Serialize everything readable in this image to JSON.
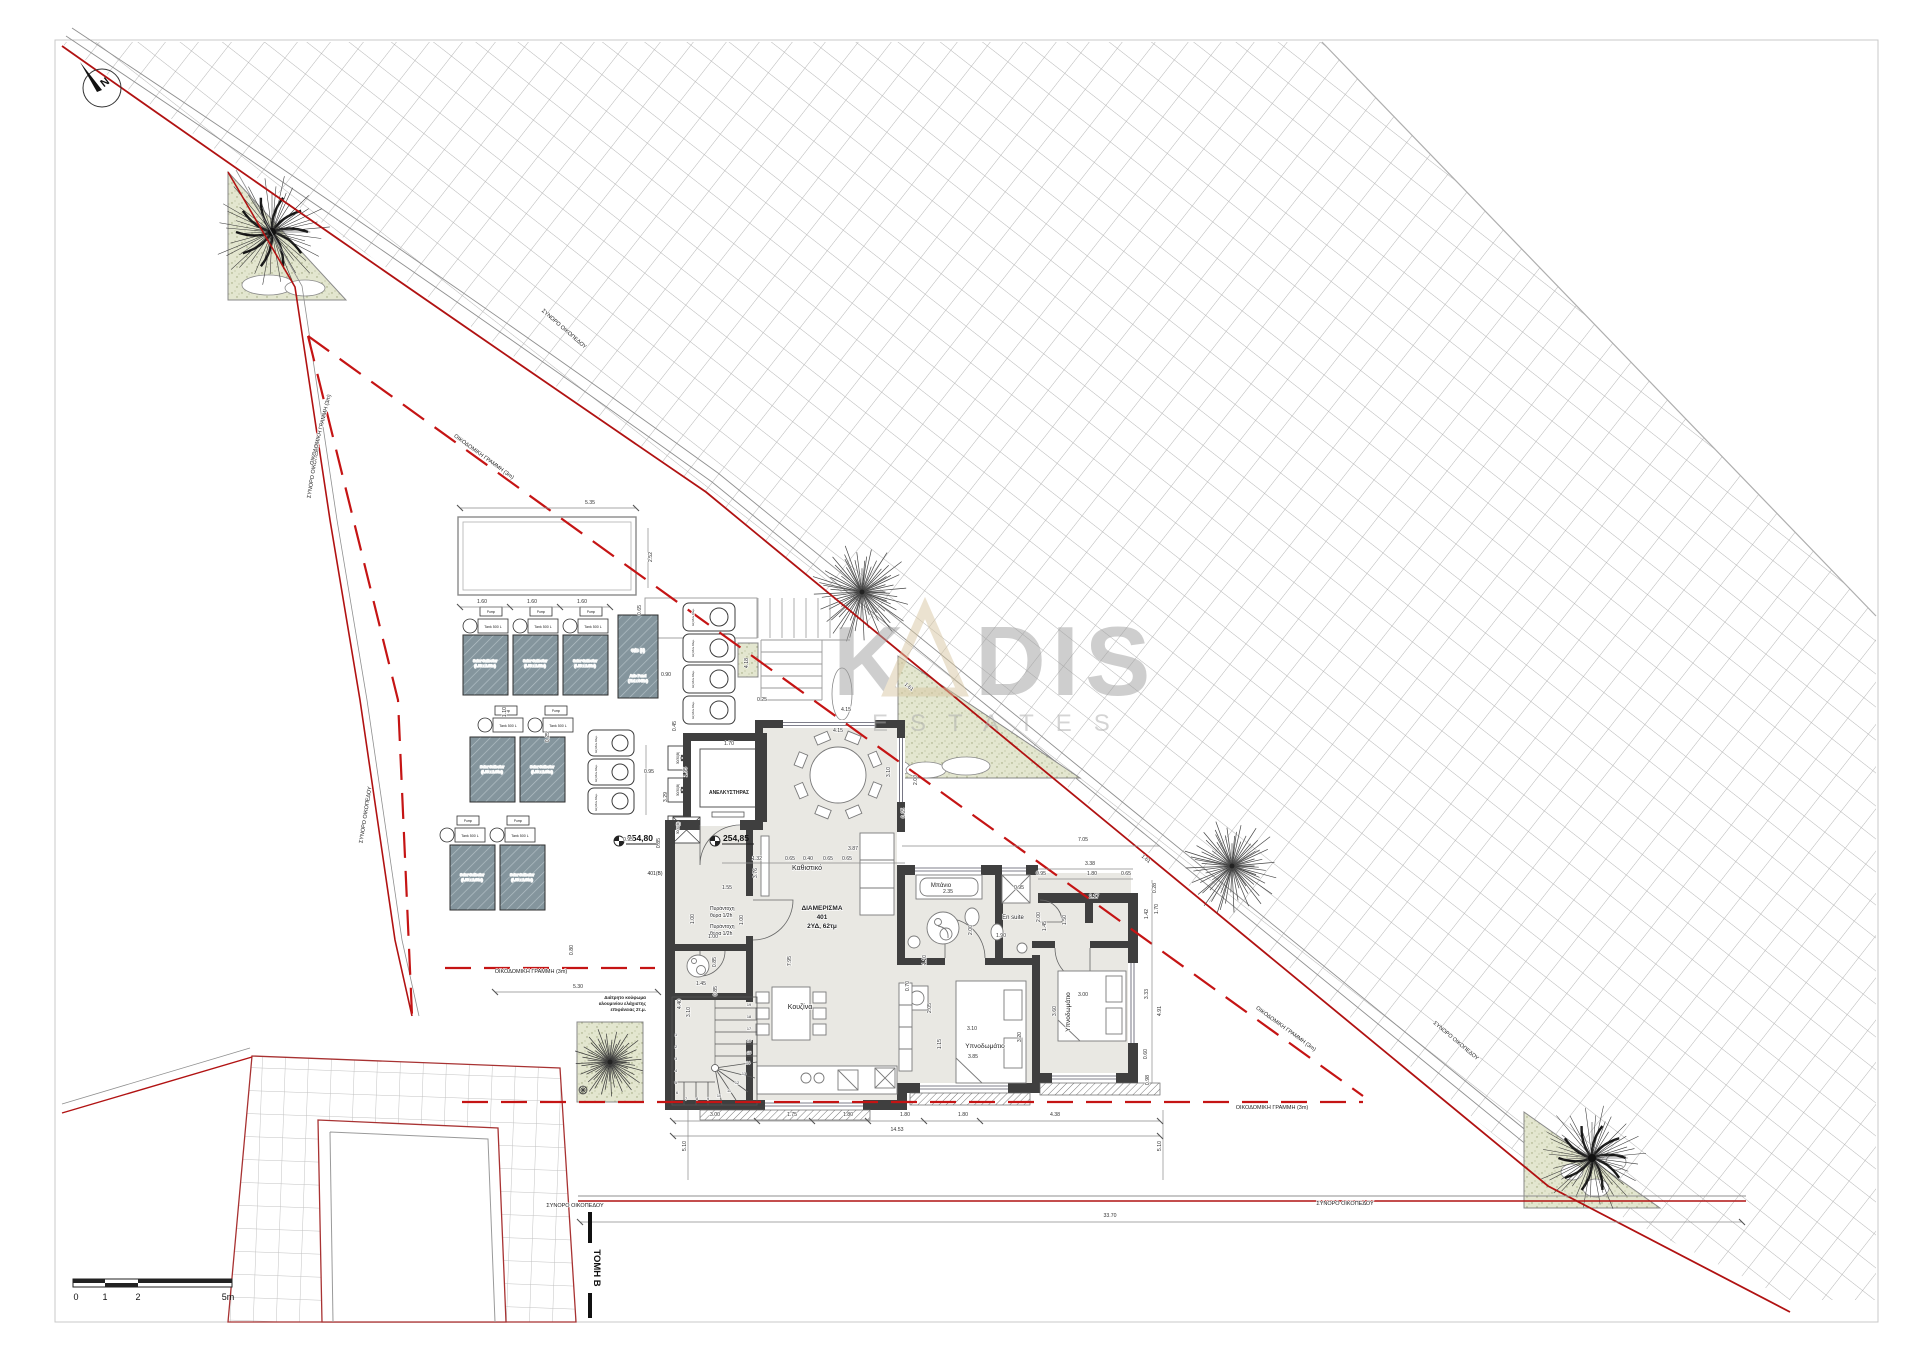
{
  "north_label": "N",
  "watermark": {
    "k": "K",
    "dis": "DIS",
    "estates": "ESTATES"
  },
  "section_mark": "ΤΟΜΗ Β",
  "scalebar": {
    "labels": [
      "0",
      "1",
      "2",
      "5m"
    ]
  },
  "elevations": [
    "254,80",
    "254,85"
  ],
  "apartment": {
    "name": "ΔΙΑΜΕΡΙΣΜΑ",
    "number": "401",
    "info": "2ΥΔ, 62τμ"
  },
  "boundary_label": "ΣΥΝΟΡΟ ΟΙΚΟΠΕΔΟΥ",
  "setback_label": "ΟΙΚΟΔΟΜΙΚΗ ΓΡΑΜΜΗ (3m)",
  "equipment": {
    "elevator": "ΑΝΕΛΚΥΣΤΗΡΑΣ",
    "pump": "Pump",
    "tank": "Tank 500 L",
    "solar1": "Solar Collector",
    "solar2": "(1.00 x 2.00m)",
    "pv1": "Φ/Β (3)",
    "pv2": "Auto Panel",
    "pv3": "(714 x 347m)",
    "ac": "Εξ.Μον.Κλιμ.",
    "shaft": "30/30(Β)"
  },
  "texts": [
    {
      "n": "boundary-label",
      "t": "ΣΥΝΟΡΟ ΟΙΚΟΠΕΔΟΥ",
      "x": 315,
      "y": 470,
      "r": -81,
      "s": 5.5
    },
    {
      "n": "boundary-label",
      "t": "ΣΥΝΟΡΟ ΟΙΚΟΠΕΔΟΥ",
      "x": 367,
      "y": 815,
      "r": -81,
      "s": 5.5
    },
    {
      "n": "boundary-label",
      "t": "ΣΥΝΟΡΟ ΟΙΚΟΠΕΔΟΥ",
      "x": 563,
      "y": 330,
      "r": 41,
      "s": 5.5
    },
    {
      "n": "boundary-label",
      "t": "ΣΥΝΟΡΟ ΟΙΚΟΠΕΔΟΥ",
      "x": 1455,
      "y": 1042,
      "r": 40,
      "s": 5.5
    },
    {
      "n": "boundary-label",
      "t": "ΣΥΝΟΡΟ ΟΙΚΟΠΕΔΟΥ",
      "x": 575,
      "y": 1207,
      "s": 5.5
    },
    {
      "n": "boundary-label",
      "t": "ΣΥΝΟΡΟ ΟΙΚΟΠΕΔΟΥ",
      "x": 1345,
      "y": 1205,
      "s": 5.5
    },
    {
      "n": "setback-label",
      "t": "ΟΙΚΟΔΟΜΙΚΗ ΓΡΑΜΜΗ (3m)",
      "x": 322,
      "y": 430,
      "r": -76,
      "s": 5.5
    },
    {
      "n": "setback-label",
      "t": "ΟΙΚΟΔΟΜΙΚΗ ΓΡΑΜΜΗ (3m)",
      "x": 483,
      "y": 458,
      "r": 36,
      "s": 5.5
    },
    {
      "n": "setback-label",
      "t": "ΟΙΚΟΔΟΜΙΚΗ ΓΡΑΜΜΗ (3m)",
      "x": 531,
      "y": 973,
      "s": 5.5
    },
    {
      "n": "setback-label",
      "t": "ΟΙΚΟΔΟΜΙΚΗ ΓΡΑΜΜΗ (3m)",
      "x": 1285,
      "y": 1030,
      "r": 36,
      "s": 5.5
    },
    {
      "n": "setback-label",
      "t": "ΟΙΚΟΔΟΜΙΚΗ ΓΡΑΜΜΗ (3m)",
      "x": 1272,
      "y": 1109,
      "s": 5.5
    },
    {
      "n": "room-label",
      "t": "Καθιστικό",
      "x": 807,
      "y": 870,
      "s": 7
    },
    {
      "n": "room-label",
      "t": "Κουζίνα",
      "x": 800,
      "y": 1009,
      "s": 7
    },
    {
      "n": "room-label",
      "t": "Μπάνιο",
      "x": 941,
      "y": 887,
      "s": 6
    },
    {
      "n": "room-label",
      "t": "En suite",
      "x": 1013,
      "y": 919,
      "s": 6
    },
    {
      "n": "room-label",
      "t": "Υπνοδωμάτιο",
      "x": 985,
      "y": 1048,
      "s": 6.5
    },
    {
      "n": "room-label",
      "t": "Υπνοδωμάτιο",
      "x": 1070,
      "y": 1012,
      "r": -90,
      "s": 6.5
    },
    {
      "n": "elevator-label",
      "t": "ΑΝΕΛΚΥΣΤΗΡΑΣ",
      "x": 729,
      "y": 794,
      "s": 5,
      "w": 700
    },
    {
      "n": "apartment-title",
      "t": "ΔΙΑΜΕΡΙΣΜΑ",
      "x": 822,
      "y": 910,
      "s": 6.5,
      "w": 700
    },
    {
      "n": "apartment-title",
      "t": "401",
      "x": 822,
      "y": 919,
      "s": 6.5,
      "w": 700
    },
    {
      "n": "apartment-title",
      "t": "2ΥΔ, 62τμ",
      "x": 822,
      "y": 928,
      "s": 6.5,
      "w": 700
    },
    {
      "n": "fire-door-label",
      "t": "Πυράντοχη",
      "x": 710,
      "y": 910,
      "s": 5,
      "a": "start"
    },
    {
      "n": "fire-door-label",
      "t": "θύρα 1/2h",
      "x": 710,
      "y": 917,
      "s": 5,
      "a": "start"
    },
    {
      "n": "fire-door-label",
      "t": "Πυράντοχη",
      "x": 710,
      "y": 928,
      "s": 5,
      "a": "start"
    },
    {
      "n": "fire-door-label",
      "t": "θύρα 1/2h",
      "x": 710,
      "y": 935,
      "s": 5,
      "a": "start"
    },
    {
      "n": "door-tag",
      "t": "401(Β)",
      "x": 655,
      "y": 875,
      "s": 5
    },
    {
      "n": "note",
      "t": "Διάτρητο κούφωμα",
      "x": 646,
      "y": 999,
      "s": 4.6,
      "a": "end",
      "w": 700
    },
    {
      "n": "note",
      "t": "αλουμινίου ελάχιστης",
      "x": 646,
      "y": 1005,
      "s": 4.6,
      "a": "end",
      "w": 700
    },
    {
      "n": "note",
      "t": "επιφάνειας 2τ.μ.",
      "x": 646,
      "y": 1011,
      "s": 4.6,
      "a": "end",
      "w": 700
    },
    {
      "n": "equipment-label",
      "t": "Solar Collector",
      "x": 485,
      "y": 662,
      "s": 3.4,
      "c": "#f2f5f5",
      "w": 600
    },
    {
      "n": "equipment-label",
      "t": "(1.00 x 2.00m)",
      "x": 485,
      "y": 667,
      "s": 3.4,
      "c": "#f2f5f5"
    },
    {
      "n": "equipment-label",
      "t": "Solar Collector",
      "x": 535,
      "y": 662,
      "s": 3.4,
      "c": "#f2f5f5",
      "w": 600
    },
    {
      "n": "equipment-label",
      "t": "(1.00 x 2.00m)",
      "x": 535,
      "y": 667,
      "s": 3.4,
      "c": "#f2f5f5"
    },
    {
      "n": "equipment-label",
      "t": "Solar Collector",
      "x": 585,
      "y": 662,
      "s": 3.4,
      "c": "#f2f5f5",
      "w": 600
    },
    {
      "n": "equipment-label",
      "t": "(1.00 x 2.00m)",
      "x": 585,
      "y": 667,
      "s": 3.4,
      "c": "#f2f5f5"
    },
    {
      "n": "equipment-label",
      "t": "Solar Collector",
      "x": 492,
      "y": 768,
      "s": 3.4,
      "c": "#f2f5f5",
      "w": 600
    },
    {
      "n": "equipment-label",
      "t": "(1.00 x 2.00m)",
      "x": 492,
      "y": 773,
      "s": 3.4,
      "c": "#f2f5f5"
    },
    {
      "n": "equipment-label",
      "t": "Solar Collector",
      "x": 542,
      "y": 768,
      "s": 3.4,
      "c": "#f2f5f5",
      "w": 600
    },
    {
      "n": "equipment-label",
      "t": "(1.00 x 2.00m)",
      "x": 542,
      "y": 773,
      "s": 3.4,
      "c": "#f2f5f5"
    },
    {
      "n": "equipment-label",
      "t": "Solar Collector",
      "x": 472,
      "y": 876,
      "s": 3.4,
      "c": "#f2f5f5",
      "w": 600
    },
    {
      "n": "equipment-label",
      "t": "(1.00 x 2.00m)",
      "x": 472,
      "y": 881,
      "s": 3.4,
      "c": "#f2f5f5"
    },
    {
      "n": "equipment-label",
      "t": "Solar Collector",
      "x": 522,
      "y": 876,
      "s": 3.4,
      "c": "#f2f5f5",
      "w": 600
    },
    {
      "n": "equipment-label",
      "t": "(1.00 x 2.00m)",
      "x": 522,
      "y": 881,
      "s": 3.4,
      "c": "#f2f5f5"
    },
    {
      "n": "equipment-label",
      "t": "Φ/Β (3)",
      "x": 638,
      "y": 652,
      "s": 4.2,
      "c": "#f2f5f5",
      "w": 700
    },
    {
      "n": "equipment-label",
      "t": "Auto Panel",
      "x": 638,
      "y": 677,
      "s": 3.4,
      "c": "#f2f5f5"
    },
    {
      "n": "equipment-label",
      "t": "(714 x 347m)",
      "x": 638,
      "y": 682,
      "s": 3.4,
      "c": "#f2f5f5"
    },
    {
      "n": "equipment-label",
      "t": "Pump",
      "x": 491,
      "y": 613,
      "s": 3.2
    },
    {
      "n": "equipment-label",
      "t": "Pump",
      "x": 541,
      "y": 613,
      "s": 3.2
    },
    {
      "n": "equipment-label",
      "t": "Pump",
      "x": 591,
      "y": 613,
      "s": 3.2
    },
    {
      "n": "equipment-label",
      "t": "Tank 500 L",
      "x": 493,
      "y": 628,
      "s": 3.6
    },
    {
      "n": "equipment-label",
      "t": "Tank 500 L",
      "x": 543,
      "y": 628,
      "s": 3.6
    },
    {
      "n": "equipment-label",
      "t": "Tank 500 L",
      "x": 593,
      "y": 628,
      "s": 3.6
    },
    {
      "n": "equipment-label",
      "t": "Pump",
      "x": 506,
      "y": 712,
      "s": 3.2
    },
    {
      "n": "equipment-label",
      "t": "Pump",
      "x": 556,
      "y": 712,
      "s": 3.2
    },
    {
      "n": "equipment-label",
      "t": "Tank 500 L",
      "x": 508,
      "y": 727,
      "s": 3.6
    },
    {
      "n": "equipment-label",
      "t": "Tank 500 L",
      "x": 558,
      "y": 727,
      "s": 3.6
    },
    {
      "n": "equipment-label",
      "t": "Pump",
      "x": 468,
      "y": 822,
      "s": 3.2
    },
    {
      "n": "equipment-label",
      "t": "Pump",
      "x": 518,
      "y": 822,
      "s": 3.2
    },
    {
      "n": "equipment-label",
      "t": "Tank 500 L",
      "x": 470,
      "y": 837,
      "s": 3.6
    },
    {
      "n": "equipment-label",
      "t": "Tank 500 L",
      "x": 520,
      "y": 837,
      "s": 3.6
    },
    {
      "n": "ac-unit-label",
      "t": "Εξ.Μον.Κλιμ.",
      "x": 694,
      "y": 617,
      "r": -90,
      "s": 3
    },
    {
      "n": "ac-unit-label",
      "t": "Εξ.Μον.Κλιμ.",
      "x": 694,
      "y": 648,
      "r": -90,
      "s": 3
    },
    {
      "n": "ac-unit-label",
      "t": "Εξ.Μον.Κλιμ.",
      "x": 694,
      "y": 679,
      "r": -90,
      "s": 3
    },
    {
      "n": "ac-unit-label",
      "t": "Εξ.Μον.Κλιμ.",
      "x": 694,
      "y": 710,
      "r": -90,
      "s": 3
    },
    {
      "n": "ac-unit-label",
      "t": "Εξ.Μον.Κλιμ.",
      "x": 597,
      "y": 744,
      "r": -90,
      "s": 3
    },
    {
      "n": "ac-unit-label",
      "t": "Εξ.Μον.Κλιμ.",
      "x": 597,
      "y": 773,
      "r": -90,
      "s": 3
    },
    {
      "n": "ac-unit-label",
      "t": "Εξ.Μον.Κλιμ.",
      "x": 597,
      "y": 802,
      "r": -90,
      "s": 3
    },
    {
      "n": "shaft-label",
      "t": "30/30(Β)",
      "x": 679,
      "y": 758,
      "r": -90,
      "s": 3.2
    },
    {
      "n": "shaft-label",
      "t": "30/30(Β)",
      "x": 679,
      "y": 790,
      "r": -90,
      "s": 3.2
    },
    {
      "n": "shaft-label",
      "t": "30/30(Β)",
      "x": 679,
      "y": 828,
      "r": -90,
      "s": 3.2
    },
    {
      "n": "stair-number",
      "t": "19",
      "x": 749,
      "y": 1006,
      "s": 3.8
    },
    {
      "n": "stair-number",
      "t": "18",
      "x": 749,
      "y": 1018,
      "s": 3.8
    },
    {
      "n": "stair-number",
      "t": "17",
      "x": 749,
      "y": 1030,
      "s": 3.8
    },
    {
      "n": "stair-number",
      "t": "16",
      "x": 749,
      "y": 1042,
      "s": 3.8
    },
    {
      "n": "stair-number",
      "t": "15",
      "x": 749,
      "y": 1054,
      "s": 3.8
    },
    {
      "n": "stair-number",
      "t": "14",
      "x": 748,
      "y": 1064,
      "s": 3.8
    },
    {
      "n": "stair-number",
      "t": "13",
      "x": 744,
      "y": 1075,
      "s": 3.8
    },
    {
      "n": "stair-number",
      "t": "12",
      "x": 737,
      "y": 1084,
      "s": 3.8
    },
    {
      "n": "stair-number",
      "t": "11",
      "x": 729,
      "y": 1092,
      "s": 3.8
    },
    {
      "n": "stair-number",
      "t": "10",
      "x": 719,
      "y": 1097,
      "s": 3.8
    },
    {
      "n": "stair-number",
      "t": "9",
      "x": 708,
      "y": 1100,
      "s": 3.8
    },
    {
      "n": "stair-number",
      "t": "8",
      "x": 697,
      "y": 1100,
      "s": 3.8
    },
    {
      "n": "stair-number",
      "t": "7",
      "x": 686,
      "y": 1100,
      "s": 3.8
    },
    {
      "n": "stair-number",
      "t": "6",
      "x": 677,
      "y": 1094,
      "s": 3.8
    },
    {
      "n": "stair-number",
      "t": "5",
      "x": 676,
      "y": 1084,
      "s": 3.8
    },
    {
      "n": "stair-number",
      "t": "4",
      "x": 676,
      "y": 1072,
      "s": 3.8
    },
    {
      "n": "stair-number",
      "t": "3",
      "x": 676,
      "y": 1060,
      "s": 3.8
    },
    {
      "n": "stair-number",
      "t": "2",
      "x": 676,
      "y": 1048,
      "s": 3.8
    },
    {
      "n": "stair-number",
      "t": "1",
      "x": 676,
      "y": 1036,
      "s": 3.8
    }
  ],
  "dims": [
    [
      "5.35",
      590,
      504
    ],
    [
      "2.52",
      652,
      557,
      -90
    ],
    [
      "1.60",
      482,
      603
    ],
    [
      "1.60",
      532,
      603
    ],
    [
      "1.60",
      582,
      603
    ],
    [
      "0.65",
      641,
      610,
      -90
    ],
    [
      "1.10",
      506,
      712,
      -90
    ],
    [
      "0.90",
      666,
      676
    ],
    [
      "4.18",
      748,
      663,
      -90
    ],
    [
      "0.45",
      676,
      726,
      -90
    ],
    [
      "0.25",
      549,
      737,
      -90
    ],
    [
      "0.95",
      649,
      773
    ],
    [
      "3.29",
      667,
      797,
      -90
    ],
    [
      "1.95",
      687,
      772,
      -90
    ],
    [
      "1.70",
      729,
      745
    ],
    [
      "0.95",
      628,
      841
    ],
    [
      "0.85",
      660,
      843,
      -90
    ],
    [
      "0.25",
      762,
      701
    ],
    [
      "4.15",
      838,
      732
    ],
    [
      "4.15",
      846,
      711
    ],
    [
      "3.10",
      890,
      772,
      -90
    ],
    [
      "2.00",
      917,
      780,
      -90
    ],
    [
      "0.65",
      905,
      813,
      -90
    ],
    [
      "1.61",
      908,
      688,
      40
    ],
    [
      "3.87",
      853,
      850
    ],
    [
      "1.32",
      757,
      860
    ],
    [
      "0.65",
      790,
      860
    ],
    [
      "0.40",
      808,
      860
    ],
    [
      "0.65",
      828,
      860
    ],
    [
      "0.65",
      847,
      860
    ],
    [
      "7.05",
      1083,
      841
    ],
    [
      "3.38",
      1090,
      865
    ],
    [
      "0.95",
      1041,
      875
    ],
    [
      "1.80",
      1092,
      875
    ],
    [
      "0.65",
      1126,
      875
    ],
    [
      "2.17",
      1094,
      898
    ],
    [
      "1.50",
      1066,
      920,
      -90
    ],
    [
      "1.45",
      1046,
      926,
      -90
    ],
    [
      "0.28",
      1156,
      888,
      -90
    ],
    [
      "1.42",
      1148,
      914,
      -90
    ],
    [
      "1.70",
      1158,
      909,
      -90
    ],
    [
      "1.61",
      1145,
      860,
      40
    ],
    [
      "2.35",
      948,
      893
    ],
    [
      "2.00",
      972,
      930,
      -90
    ],
    [
      "0.95",
      1019,
      889
    ],
    [
      "1.90",
      1001,
      937
    ],
    [
      "2.00",
      1040,
      917,
      -90
    ],
    [
      "1.10",
      926,
      960,
      -90
    ],
    [
      "2.05",
      931,
      1008,
      -90
    ],
    [
      "0.70",
      909,
      986,
      -90
    ],
    [
      "1.15",
      941,
      1044,
      -90
    ],
    [
      "3.76",
      757,
      873,
      -90
    ],
    [
      "1.55",
      727,
      889
    ],
    [
      "1.00",
      694,
      919,
      -90
    ],
    [
      "1.00",
      743,
      920,
      -90
    ],
    [
      "1.00",
      713,
      938
    ],
    [
      "1.45",
      701,
      985
    ],
    [
      "0.85",
      716,
      962,
      -90
    ],
    [
      "4.40",
      681,
      1004,
      -90
    ],
    [
      "0.85",
      717,
      991,
      -90
    ],
    [
      "3.10",
      690,
      1012,
      -90
    ],
    [
      "7.95",
      791,
      961,
      -90
    ],
    [
      "3.10",
      972,
      1030
    ],
    [
      "3.85",
      973,
      1058
    ],
    [
      "3.20",
      1021,
      1037,
      -90
    ],
    [
      "3.00",
      1083,
      996
    ],
    [
      "3.60",
      1056,
      1011,
      -90
    ],
    [
      "3.33",
      1148,
      994,
      -90
    ],
    [
      "4.91",
      1161,
      1011,
      -90
    ],
    [
      "0.60",
      1147,
      1054,
      -90
    ],
    [
      "0.98",
      1149,
      1080,
      -90
    ],
    [
      "3.00",
      715,
      1116
    ],
    [
      "1.75",
      792,
      1116
    ],
    [
      "1.80",
      848,
      1116
    ],
    [
      "1.80",
      905,
      1116
    ],
    [
      "1.80",
      963,
      1116
    ],
    [
      "4.38",
      1055,
      1116
    ],
    [
      "14.53",
      897,
      1131
    ],
    [
      "5.10",
      686,
      1146,
      -90
    ],
    [
      "5.10",
      1161,
      1146,
      -90
    ],
    [
      "33.70",
      1110,
      1217
    ],
    [
      "5.30",
      578,
      988
    ],
    [
      "0.80",
      573,
      950,
      -90
    ]
  ]
}
